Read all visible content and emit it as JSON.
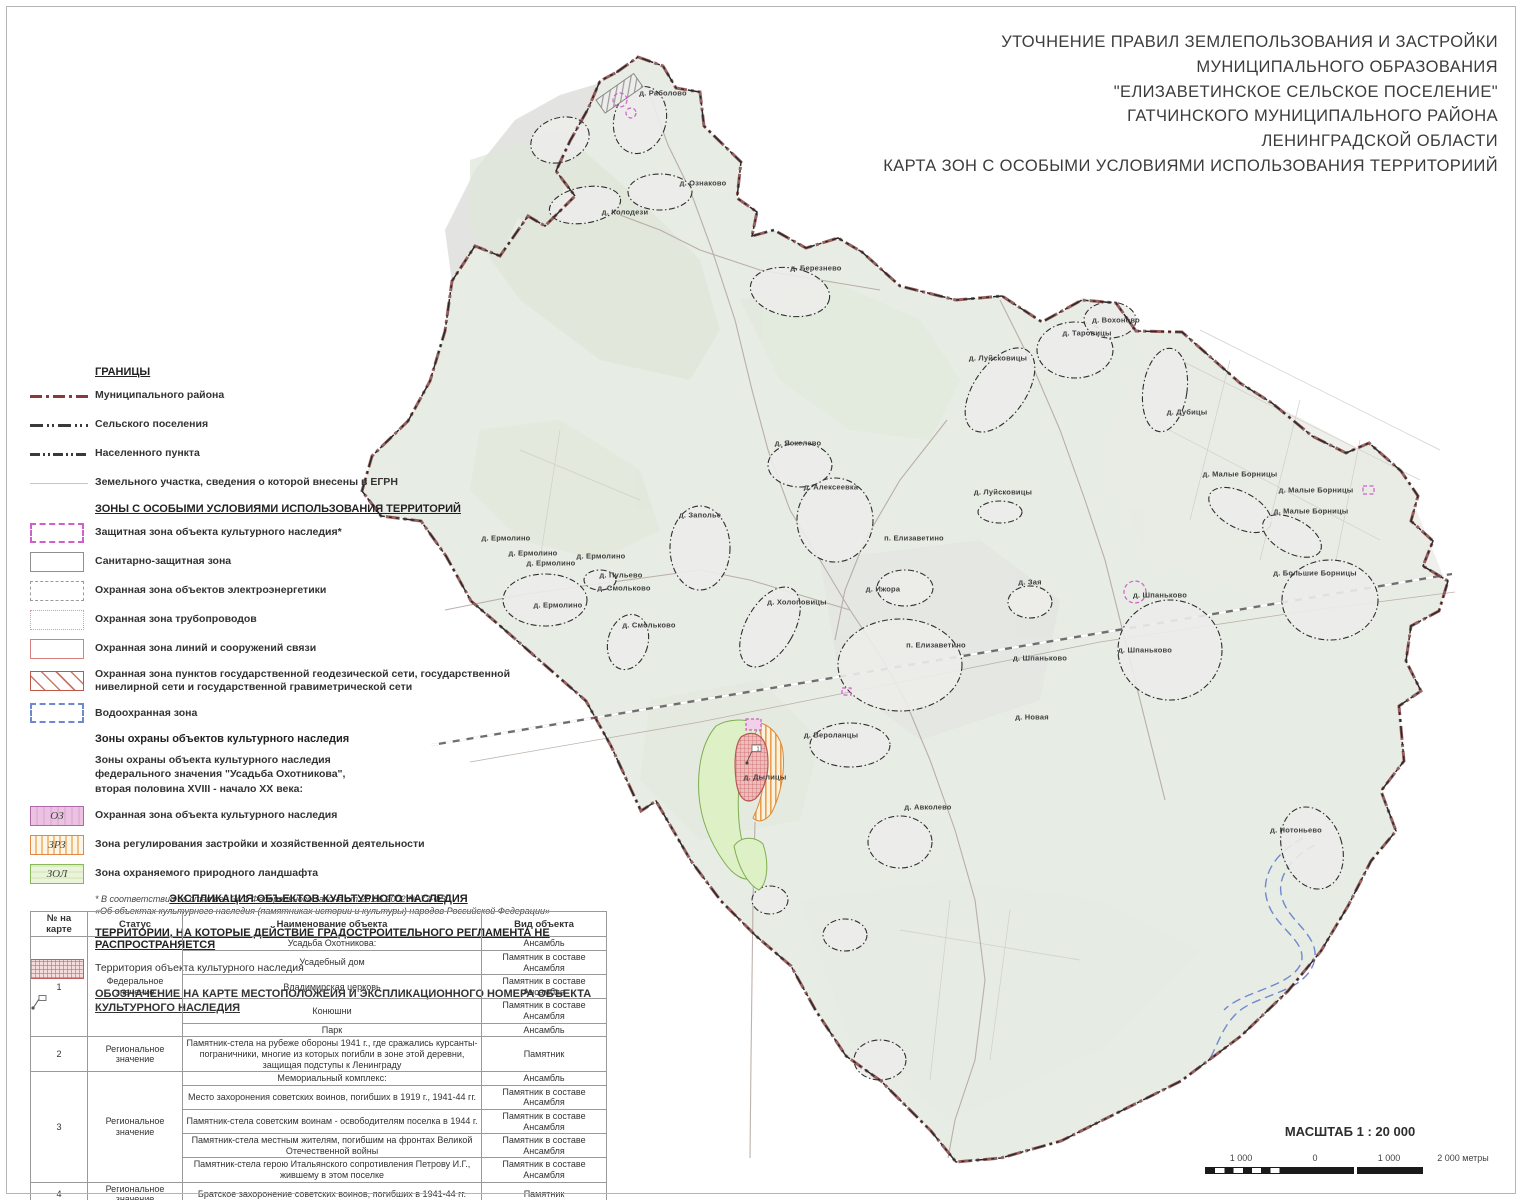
{
  "title": {
    "lines": [
      "УТОЧНЕНИЕ ПРАВИЛ ЗЕМЛЕПОЛЬЗОВАНИЯ И ЗАСТРОЙКИ",
      "МУНИЦИПАЛЬНОГО ОБРАЗОВАНИЯ",
      "\"ЕЛИЗАВЕТИНСКОЕ  СЕЛЬСКОЕ ПОСЕЛЕНИЕ\"",
      "ГАТЧИНСКОГО МУНИЦИПАЛЬНОГО РАЙОНА",
      "ЛЕНИНГРАДСКОЙ ОБЛАСТИ",
      "КАРТА ЗОН С ОСОБЫМИ УСЛОВИЯМИ ИСПОЛЬЗОВАНИЯ ТЕРРИТОРИИЙ"
    ]
  },
  "legend": {
    "borders_heading": "ГРАНИЦЫ",
    "borders": [
      {
        "label": "Муниципального района"
      },
      {
        "label": "Сельского поселения"
      },
      {
        "label": "Населенного пункта"
      },
      {
        "label": "Земельного участка, сведения о которой внесены в ЕГРН"
      }
    ],
    "zones_heading": "ЗОНЫ С ОСОБЫМИ УСЛОВИЯМИ ИСПОЛЬЗОВАНИЯ ТЕРРИТОРИЙ",
    "zones": [
      {
        "label": "Защитная зона объекта культурного наследия*"
      },
      {
        "label": "Санитарно-защитная зона"
      },
      {
        "label": "Охранная зона объектов электроэнергетики"
      },
      {
        "label": "Охранная зона трубопроводов"
      },
      {
        "label": "Охранная зона линий и сооружений связи"
      },
      {
        "label": "Охранная зона пунктов государственной геодезической сети, государственной нивелирной сети и государственной гравиметрической сети"
      },
      {
        "label": "Водоохранная зона"
      }
    ],
    "okn_heading": "Зоны охраны объектов культурного наследия",
    "okn_paragraph": "Зоны охраны объекта культурного наследия\nфедерального значения \"Усадьба Охотникова\",\nвторая половина XVIII - начало XX века:",
    "okn_zones": [
      {
        "code": "ОЗ",
        "label": "Охранная зона объекта культурного наследия"
      },
      {
        "code": "ЗРЗ",
        "label": "Зона регулирования застройки и хозяйственной деятельности"
      },
      {
        "code": "ЗОЛ",
        "label": "Зона охраняемого природного ландшафта"
      }
    ],
    "footnote": "*  В соответствии со статьей 34.1 Федерального закона от 25.06.2002 № 73-ФЗ\n«Об объектах культурного наследия (памятниках истории и культуры) народов Российской Федерации»",
    "territories_heading": "ТЕРРИТОРИИ, НА КОТОРЫЕ  ДЕЙСТВИЕ ГРАДОСТРОИТЕЛЬНОГО РЕГЛАМЕНТА НЕ РАСПРОСТРАНЯЕТСЯ",
    "territory_label": "Территория объекта культурного наследия",
    "designation_heading": "ОБОЗНАЧЕНИЕ НА КАРТЕ МЕСТОПОЛОЖЕИЯ И ЭКСПЛИКАЦИОННОГО НОМЕРА ОБЪЕКТА КУЛЬТУРНОГО НАСЛЕДИЯ"
  },
  "table": {
    "heading": "ЭКСПЛИКАЦИЯ ОБЪЕКТОВ КУЛЬТУРНОГО НАСЛЕДИЯ",
    "columns": [
      "№ на карте",
      "Статус",
      "Наименование объекта",
      "Вид объекта"
    ],
    "groups": [
      {
        "num": "1",
        "status": "Федеральное значение",
        "rows": [
          [
            "Усадьба Охотникова:",
            "Ансамбль"
          ],
          [
            "Усадебный дом",
            "Памятник в составе Ансамбля"
          ],
          [
            "Владимирская церковь",
            "Памятник в составе Ансамбля"
          ],
          [
            "Конюшни",
            "Памятник в составе Ансамбля"
          ],
          [
            "Парк",
            "Ансамбль"
          ]
        ]
      },
      {
        "num": "2",
        "status": "Региональное значение",
        "rows": [
          [
            "Памятник-стела на рубеже обороны 1941 г., где сражались курсанты-пограничники, многие из которых погибли в зоне этой деревни, защищая подступы к Ленинграду",
            "Памятник"
          ]
        ]
      },
      {
        "num": "3",
        "status": "Региональное значение",
        "rows": [
          [
            "Мемориальный комплекс:",
            "Ансамбль"
          ],
          [
            "Место захоронения советских воинов, погибших в 1919 г., 1941-44 гг.",
            "Памятник в составе Ансамбля"
          ],
          [
            "Памятник-стела советским воинам - освободителям поселка в 1944 г.",
            "Памятник в составе Ансамбля"
          ],
          [
            "Памятник-стела местным жителям, погибшим на фронтах Великой Отечественной войны",
            "Памятник в составе Ансамбля"
          ],
          [
            "Памятник-стела герою Итальянского сопротивления Петрову И.Г., жившему в этом поселке",
            "Памятник в составе Ансамбля"
          ]
        ]
      },
      {
        "num": "4",
        "status": "Региональное значение",
        "rows": [
          [
            "Братское захоронение советских воинов, погибших в 1941-44 гг.",
            "Памятник"
          ]
        ]
      },
      {
        "num": "5",
        "status": "Региональное значение",
        "rows": [
          [
            "Кирха Святой Марии",
            "Памятник"
          ]
        ]
      }
    ]
  },
  "scale": {
    "title": "МАСШТАБ 1 : 20 000",
    "ticks": [
      "1 000",
      "0",
      "1 000",
      "2 000 метры"
    ]
  },
  "map": {
    "marker_number": "1",
    "settlements": [
      {
        "name": "д. Раболово",
        "x": 663,
        "y": 93
      },
      {
        "name": "д. Ознаково",
        "x": 703,
        "y": 183
      },
      {
        "name": "д. Колодези",
        "x": 625,
        "y": 212
      },
      {
        "name": "д. Березнево",
        "x": 816,
        "y": 268
      },
      {
        "name": "д. Вохоново",
        "x": 1116,
        "y": 320
      },
      {
        "name": "д. Таровицы",
        "x": 1087,
        "y": 333
      },
      {
        "name": "д. Луйсковицы",
        "x": 998,
        "y": 358
      },
      {
        "name": "д. Луйсковицы",
        "x": 1003,
        "y": 492
      },
      {
        "name": "д. Дубицы",
        "x": 1187,
        "y": 412
      },
      {
        "name": "д. Малые Борницы",
        "x": 1240,
        "y": 474
      },
      {
        "name": "д. Малые Борницы",
        "x": 1316,
        "y": 490
      },
      {
        "name": "д. Малые Борницы",
        "x": 1311,
        "y": 511
      },
      {
        "name": "д. Большие Борницы",
        "x": 1315,
        "y": 573
      },
      {
        "name": "д. Заполье",
        "x": 700,
        "y": 515
      },
      {
        "name": "д. Ермолино",
        "x": 506,
        "y": 538
      },
      {
        "name": "д. Ермолино",
        "x": 533,
        "y": 553
      },
      {
        "name": "д. Ермолино",
        "x": 551,
        "y": 563
      },
      {
        "name": "д. Ермолино",
        "x": 601,
        "y": 556
      },
      {
        "name": "д. Ермолино",
        "x": 558,
        "y": 605
      },
      {
        "name": "д. Пульево",
        "x": 621,
        "y": 575
      },
      {
        "name": "д. Смольково",
        "x": 624,
        "y": 588
      },
      {
        "name": "д. Смольково",
        "x": 649,
        "y": 625
      },
      {
        "name": "д. Холоповицы",
        "x": 797,
        "y": 602
      },
      {
        "name": "д. Алексеевка",
        "x": 831,
        "y": 487
      },
      {
        "name": "д. Яскелево",
        "x": 798,
        "y": 443
      },
      {
        "name": "д. Ижора",
        "x": 883,
        "y": 589
      },
      {
        "name": "п. Елизаветино",
        "x": 914,
        "y": 538
      },
      {
        "name": "п. Елизаветино",
        "x": 936,
        "y": 645
      },
      {
        "name": "д. Зая",
        "x": 1030,
        "y": 582
      },
      {
        "name": "д. Шпаньково",
        "x": 1160,
        "y": 595
      },
      {
        "name": "д. Шпаньково",
        "x": 1145,
        "y": 650
      },
      {
        "name": "д. Шпаньково",
        "x": 1040,
        "y": 658
      },
      {
        "name": "д. Новая",
        "x": 1032,
        "y": 717
      },
      {
        "name": "д. Вероланцы",
        "x": 831,
        "y": 735
      },
      {
        "name": "д. Дылицы",
        "x": 765,
        "y": 777
      },
      {
        "name": "д. Авколево",
        "x": 928,
        "y": 807
      },
      {
        "name": "д. Нотоньево",
        "x": 1296,
        "y": 830
      }
    ]
  },
  "colors": {
    "district_border": "#8a3838",
    "oz_fill": "#ecc2e2",
    "zrz_stripe": "#f0c080",
    "zol_fill": "#eaf4da",
    "territory_hatch": "#c85a5a",
    "water_zone": "#7088cc",
    "map_fill": "#e7ece4"
  }
}
